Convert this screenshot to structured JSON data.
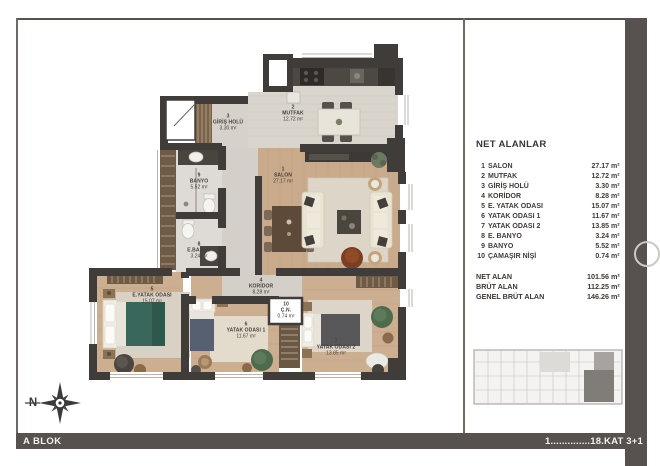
{
  "footer": {
    "left": "A BLOK",
    "right": "1..............18.KAT 3+1"
  },
  "panel": {
    "title": "NET ALANLAR",
    "unit": "m²",
    "rooms": [
      {
        "no": "1",
        "name": "SALON",
        "area": "27.17"
      },
      {
        "no": "2",
        "name": "MUTFAK",
        "area": "12.72"
      },
      {
        "no": "3",
        "name": "GİRİŞ HOLÜ",
        "area": "3.30"
      },
      {
        "no": "4",
        "name": "KORİDOR",
        "area": "8.28"
      },
      {
        "no": "5",
        "name": "E. YATAK ODASI",
        "area": "15.07"
      },
      {
        "no": "6",
        "name": "YATAK ODASI 1",
        "area": "11.67"
      },
      {
        "no": "7",
        "name": "YATAK ODASI 2",
        "area": "13.85"
      },
      {
        "no": "8",
        "name": "E. BANYO",
        "area": "3.24"
      },
      {
        "no": "9",
        "name": "BANYO",
        "area": "5.52"
      },
      {
        "no": "10",
        "name": "ÇAMAŞIR NİŞİ",
        "area": "0.74"
      }
    ],
    "totals": [
      {
        "label": "NET ALAN",
        "value": "101.56"
      },
      {
        "label": "BRÜT ALAN",
        "value": "112.25"
      },
      {
        "label": "GENEL BRÜT ALAN",
        "value": "146.26"
      }
    ]
  },
  "plan": {
    "compass_label": "N",
    "labels": [
      {
        "no": "1",
        "name": "SALON",
        "area": "27.17 m²"
      },
      {
        "no": "2",
        "name": "MUTFAK",
        "area": "12.72 m²"
      },
      {
        "no": "3",
        "name": "GİRİŞ HOLÜ",
        "area": "3.30 m²"
      },
      {
        "no": "4",
        "name": "KORİDOR",
        "area": "8.28 m²"
      },
      {
        "no": "5",
        "name": "E.YATAK ODASI",
        "area": "15.07 m²"
      },
      {
        "no": "6",
        "name": "YATAK ODASI 1",
        "area": "11.67 m²"
      },
      {
        "no": "7",
        "name": "YATAK ODASI 2",
        "area": "13.85 m²"
      },
      {
        "no": "8",
        "name": "E.BANYO",
        "area": "3.24 m²"
      },
      {
        "no": "9",
        "name": "BANYO",
        "area": "5.52 m²"
      },
      {
        "no": "10",
        "name": "Ç.N.",
        "area": "0.74 m²"
      }
    ]
  },
  "colors": {
    "bar": "#575250",
    "wall": "#403c39",
    "wood_floor": "#c9ab8c",
    "tile_floor": "#d8d4cd",
    "master_bed": "#3a675b",
    "keyplan_highlight": "#807d79"
  }
}
